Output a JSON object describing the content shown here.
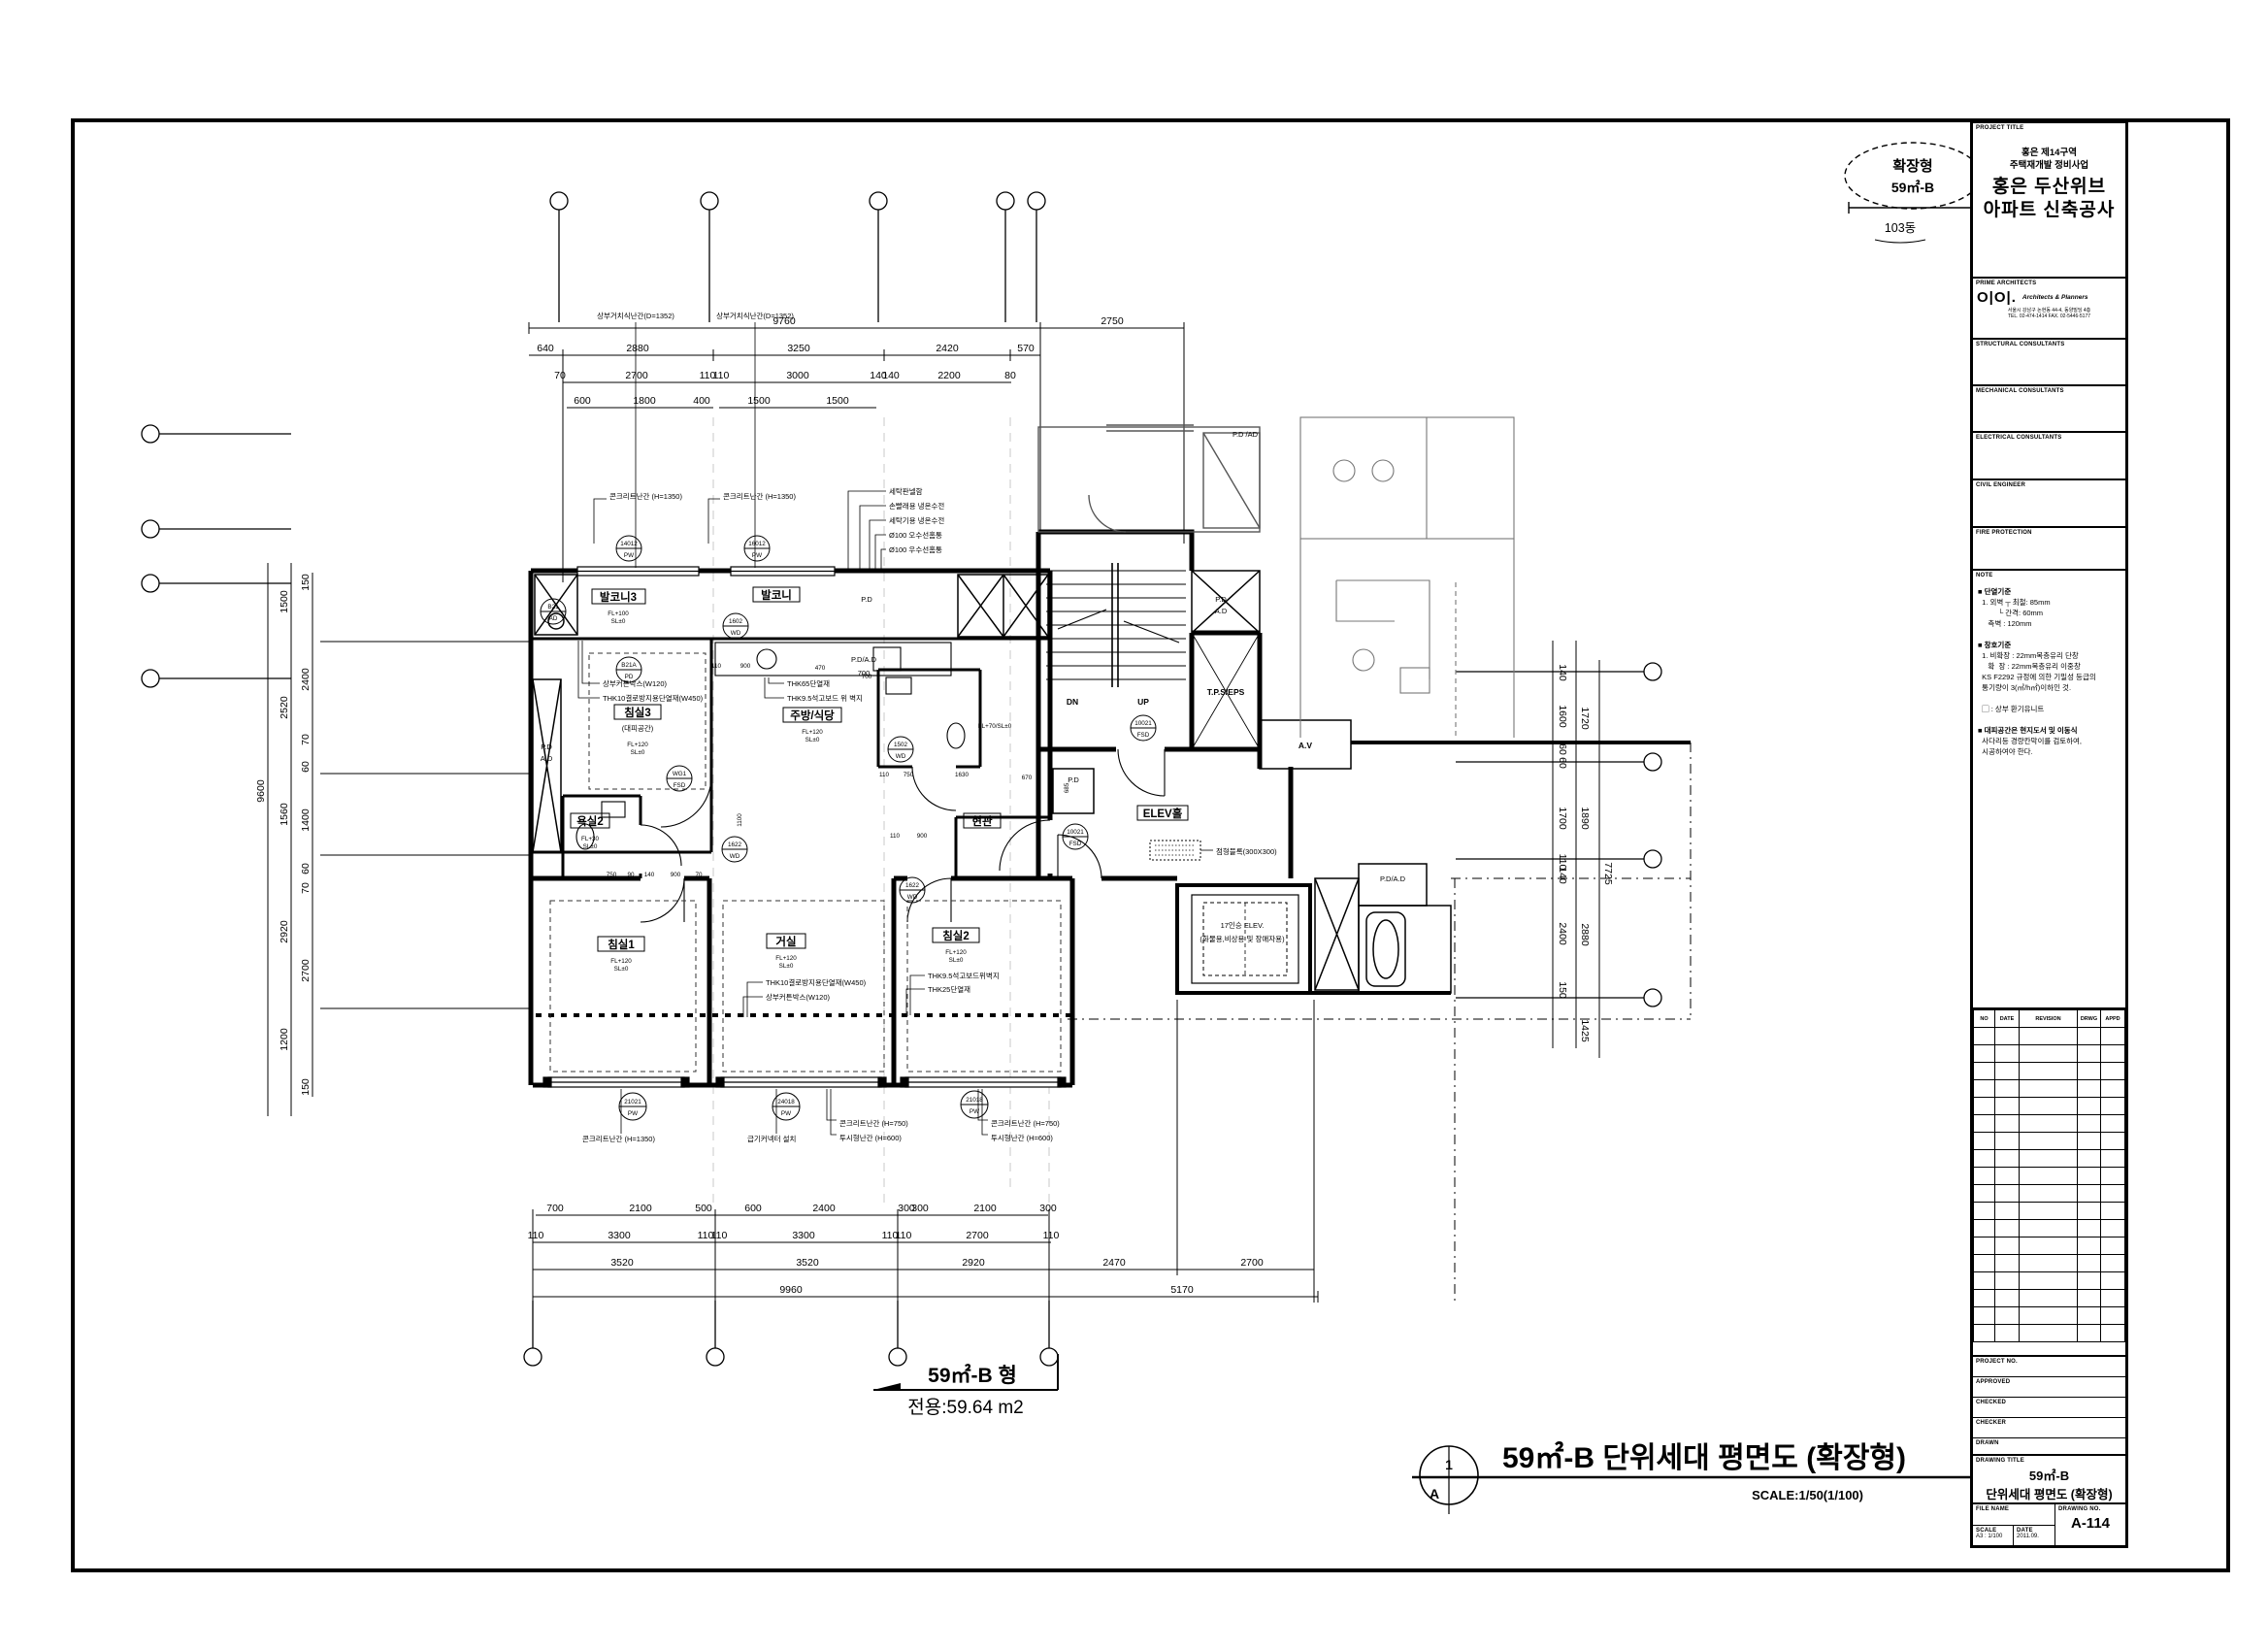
{
  "stamp": {
    "line1": "확장형",
    "line2": "59㎡-B",
    "line3": "103동"
  },
  "footer": {
    "bubble_top": "1",
    "bubble_bottom": "A",
    "title": "59㎡-B 단위세대 평면도 (확장형)",
    "scale": "SCALE:1/50(1/100)"
  },
  "area_label": {
    "line1": "59㎡-B 형",
    "line2": "전용:59.64 m2"
  },
  "titleblock": {
    "project_title_label": "PROJECT TITLE",
    "pt_small1": "홍은 제14구역",
    "pt_small2": "주택재개발 정비사업",
    "pt_big1": "홍은 두산위브",
    "pt_big2": "아파트 신축공사",
    "architect_label": "PRIME ARCHITECTS",
    "architect_logo": "O|O|.",
    "architect_firm": "Architects & Planners",
    "architect_addr1": "서울시 강남구 논현동 44-4, 동양빌딩 4층",
    "architect_addr2": "TEL. 02-474-1414  FAX. 02-5446-5177",
    "sec_structural": "STRUCTURAL CONSULTANTS",
    "sec_mechanical": "MECHANICAL CONSULTANTS",
    "sec_electrical": "ELECTRICAL CONSULTANTS",
    "sec_civil": "CIVIL ENGINEER",
    "sec_fire": "FIRE PROTECTION",
    "note_label": "NOTE",
    "notes": [
      "■ 단열기준",
      "  1. 외벽 ┬ 최철: 85mm",
      "          └ 간격: 60mm",
      "     측벽 : 120mm",
      "",
      "■ 창호기준",
      "  1. 비확장 : 22mm복층유리 단창",
      "     확  장 : 22mm복층유리 이중창",
      "  KS F2292 규정에 의한 기밀성 등급의",
      "  통기량이 3(㎥/h㎡)이하인 것.",
      "",
      "  ▢ : 상부 환기유니트",
      "",
      "■ 대피공간은 현지도서 및 이동식",
      "  사다리등 경량칸막이를 검토하여,",
      "  시공하여야 한다."
    ],
    "rev_headers": [
      "NO",
      "DATE",
      "REVISION",
      "DRWG",
      "APPD"
    ],
    "meta1": "PROJECT NO.",
    "meta2": "APPROVED",
    "meta3": "CHECKED",
    "meta4": "CHECKER",
    "meta5": "DRAWN",
    "drawing_title_label": "DRAWING TITLE",
    "dt_line1": "59㎡-B",
    "dt_line2": "단위세대 평면도 (확장형)",
    "file_label": "FILE NAME",
    "dwgno_label": "DRAWING NO.",
    "scale_label": "SCALE",
    "scale_value": "A3 : 1/100",
    "date_label": "DATE",
    "date_value": "2011.09.",
    "drawing_no": "A-114"
  },
  "plan": {
    "dims": {
      "t1": [
        "9760",
        "2750"
      ],
      "t2": [
        "640",
        "2880",
        "3250",
        "2420",
        "570"
      ],
      "t3": [
        "70",
        "2700",
        "110",
        "110",
        "3000",
        "140",
        "140",
        "2200",
        "80"
      ],
      "t4": [
        "600",
        "1800",
        "400",
        "1500",
        "1500"
      ],
      "b1": [
        "700",
        "2100",
        "500",
        "600",
        "2400",
        "300",
        "300",
        "2100",
        "300"
      ],
      "b2": [
        "110",
        "3300",
        "110",
        "110",
        "3300",
        "110",
        "110",
        "2700",
        "110"
      ],
      "b3": [
        "3520",
        "3520",
        "2920",
        "2470",
        "2700"
      ],
      "b4": [
        "9960",
        "5170"
      ],
      "l1": "9600",
      "l2": [
        "1500",
        "2520",
        "1560",
        "2920",
        "1200"
      ],
      "l3": [
        "150",
        "2400",
        "70",
        "60",
        "1400",
        "60",
        "70",
        "2700",
        "150"
      ],
      "r1": [
        "140",
        "1600",
        "60",
        "60",
        "1700",
        "110",
        "140",
        "2400",
        "150"
      ],
      "r2": [
        "1720",
        "1890",
        "2880",
        "1425"
      ],
      "r3": "7725",
      "i": [
        "110",
        "900",
        "110",
        "750",
        "1630",
        "670",
        "685",
        "1100",
        "750",
        "90",
        "140",
        "900",
        "70",
        "470",
        "700",
        "110",
        "900"
      ]
    },
    "rooms": {
      "balcony3": "발코니3",
      "balcony": "발코니",
      "bed3": "침실3",
      "bed3_sub": "(대피공간)",
      "kitchen": "주방/식당",
      "bath2": "욕실2",
      "entry": "현관",
      "bed1": "침실1",
      "living": "거실",
      "bed2": "침실2",
      "elevhall": "ELEV홀",
      "tps": "T.P.S/EPS",
      "av": "A.V",
      "dn": "DN",
      "up": "UP",
      "pd": "P.D",
      "ad": "A.D",
      "pdad": "P.D/A.D",
      "pdad_top": "P.D /AD",
      "elev1": "17인승 ELEV.",
      "elev2": "(화물용,비상용 및 장애자용)"
    },
    "levels": {
      "fl120": "FL+120",
      "fl100": "FL+100",
      "fl70": "FL+70/SL±0",
      "fl30": "FL+30",
      "sl": "SL±0"
    },
    "notes": {
      "rail1352": "상부거치식난간(D=1352)",
      "conc1350": "콘크리트난간 (H=1350)",
      "laundry": [
        "세탁판넬함",
        "손빨래용 냉온수전",
        "세탁기용 냉온수전",
        "Ø100 오수선홈통",
        "Ø100 우수선홈통"
      ],
      "curtain": "상부커튼박스(W120)",
      "thk10": "THK10결로방지용단열재(W450)",
      "thk65": "THK65단열재",
      "gypsum": "THK9.5석고보드 위 벽지",
      "gypsum2": "THK9.5석고보드위벽지",
      "thk25": "THK25단열재",
      "conc750": "콘크리트난간 (H=750)",
      "seethru": "투시형난간 (H=600)",
      "damper": "급기커넥터 설치",
      "braille": "점형블록(300X300)",
      "d700": "700"
    },
    "tags": [
      {
        "a": "14012",
        "b": "PW"
      },
      {
        "a": "16012",
        "b": "PW"
      },
      {
        "a": "B21",
        "b": "AD"
      },
      {
        "a": "1602",
        "b": "WD"
      },
      {
        "a": "B21A",
        "b": "PD"
      },
      {
        "a": "1502",
        "b": "WD"
      },
      {
        "a": "WG1",
        "b": "FSD"
      },
      {
        "a": "1622",
        "b": "WD"
      },
      {
        "a": "1622",
        "b": "WD"
      },
      {
        "a": "21021",
        "b": "PW"
      },
      {
        "a": "24018",
        "b": "PW"
      },
      {
        "a": "21018",
        "b": "PW"
      },
      {
        "a": "10021",
        "b": "FSD"
      },
      {
        "a": "10021",
        "b": "FSD"
      }
    ]
  }
}
